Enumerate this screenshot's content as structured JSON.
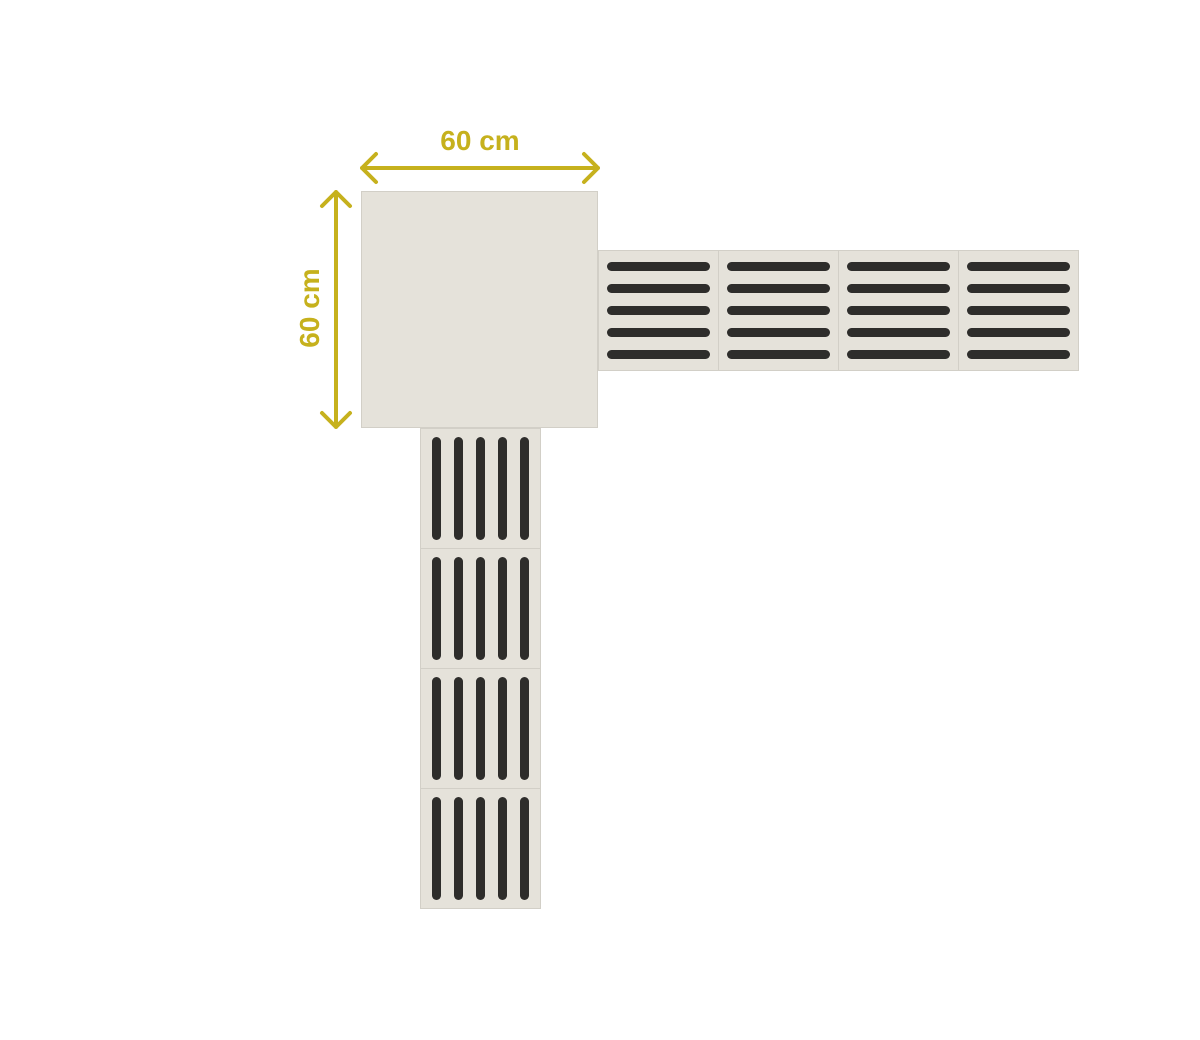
{
  "diagram": {
    "description": "Tactile paving corner layout with dimension arrows",
    "labels": {
      "top": "60 cm",
      "left": "60 cm"
    },
    "colors": {
      "background": "#ffffff",
      "tile_fill": "#e5e2da",
      "tile_border": "#d2cfc7",
      "bar": "#2e2d2b",
      "dimension": "#c6b11d"
    },
    "corner_tile": {
      "pattern": "plain",
      "width": "60 cm",
      "height": "60 cm"
    },
    "horizontal_row": {
      "tile_count": 4,
      "bars_per_tile": 5,
      "bar_direction": "horizontal"
    },
    "vertical_column": {
      "tile_count": 4,
      "bars_per_tile": 5,
      "bar_direction": "vertical"
    }
  }
}
